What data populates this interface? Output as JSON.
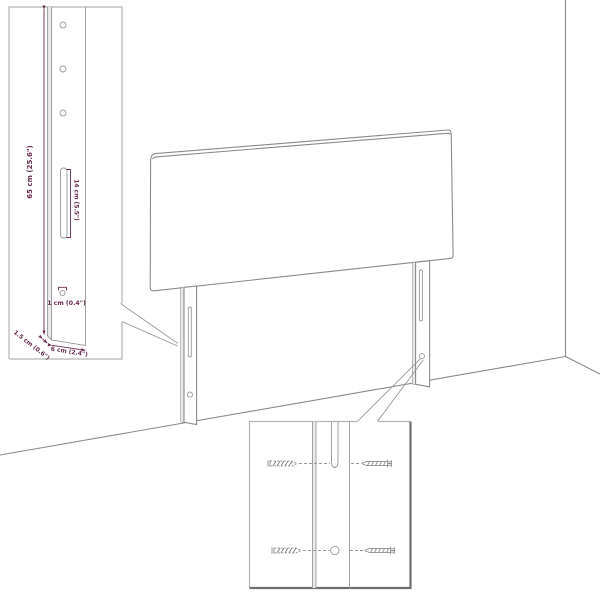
{
  "diagram": {
    "type": "product-dimension-diagram",
    "subject": "upholstered headboard with two mounting legs, wall corner scene, leg detail inset and screw-mounting detail inset",
    "colors": {
      "background": "#ffffff",
      "outline_gray": "#8a8a8a",
      "dimension_accent": "#682c4f"
    },
    "inset_detail": {
      "labels": {
        "height": "65 cm (25.6\")",
        "slot": "14 cm (5.5\")",
        "hole": "1 cm (0.4\")",
        "thickness": "1.5 cm (0.6\")",
        "width": "6 cm (2.4\")"
      }
    }
  }
}
